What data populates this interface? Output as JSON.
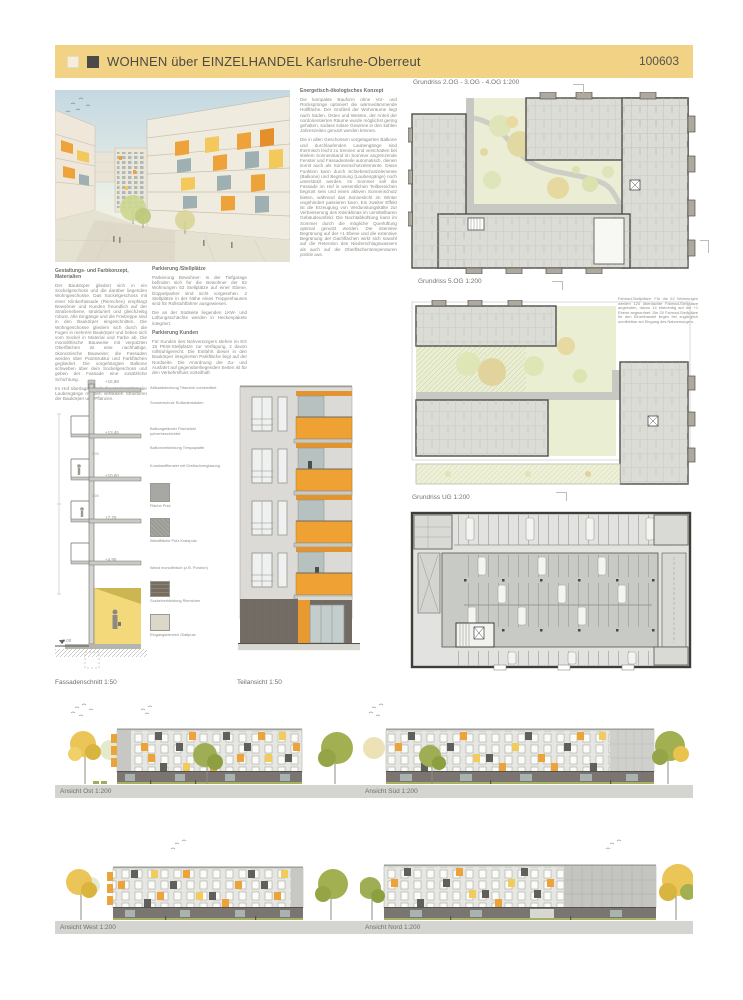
{
  "header": {
    "title": "WOHNEN über EINZELHANDEL Karlsruhe-Oberreut",
    "number": "100603"
  },
  "texts": {
    "materials": {
      "heading": "Gestaltungs- und Farbkonzept, Materialien",
      "body": "Der Baukörper gliedert sich in ein Sockelgeschoss und die darüber liegenden Wohngeschosse. Das Sockelgeschoss mit einer Klinkerfassade (Riemchen) empfängt Bewohner und Kunden freundlich auf der Straßenebene, strukturiert und gleichzeitig robust. Alle Eingänge und die Freitreppe sind in den Baukörper eingeschnitten. Die Wohngeschosse gliedern sich durch die Fugen in mehrere Baukörper und heben sich vom Sockel in Material und Farbe ab. Die monolithische Bauweise mit verputzten Oberflächen ist eine nachhaltige, ökonomische Bauweise; die Fassaden werden über Putzstruktur und Farbflächen gegliedert. Die vorgehängten Balkone schweben über dem Sockelgeschoss und geben der Fassade eine zusätzliche Schichtung.",
      "body2": "Im Hof überlagern sich die Horizontalen der Laubengänge mit den vertikalen Strukturen der Baukörper und Pflanzen."
    },
    "parking": {
      "heading": "Parkierung /Stellplätze",
      "body": "Parkierung Bewohner: In der Tiefgarage befinden sich für die Bewohner der 62 Wohnungen 62 Stellplätze auf einer Ebene. Doppelparker sind nicht vorgesehen. 2 Stellplätze in der Nähe eines Treppenhauses sind für Rollstuhlfahrer ausgewiesen.",
      "body2": "Die an der Südseite liegenden LKW- und Lüftungsschächte werden in Heckenpakete integriert.",
      "heading2": "Parkierung Kunden",
      "body3": "Für Kunden des Nahversorgers stehen im EG 18 PKW-Stellplätze zur Verfügung, 2 davon rollstuhlgerecht. Die Einfahrt dieser in den Baukörper integrierten Parkfläche liegt auf der Nordseite. Die Anordnung der Zu- und Ausfahrt auf gegenüberliegenden Seiten ist für den Verkehrsfluss vorteilhaft."
    },
    "energy": {
      "heading": "Energetisch-ökologisches Konzept",
      "body": "Die kompakte Bauform ohne Vor- und Rücksprünge optimiert die wärmedämmende Hüllfläche. Der Großteil der Wohnräume liegt nach Süden, Osten und Westen, der Anteil der nordorientierten Räume wurde möglichst gering gehalten, sodass solare Gewinne in den kühlen Jahreszeiten genutzt werden können.",
      "body2": "Die in allen Geschossen vorgelagerten Balkone und durchlaufenden Laubengänge sind thermisch leicht zu trennen und verschatten bei steilem Sonnenstand im Sommer angrenzende Fenster und Fassadenteile automatisch, dienen somit auch als Sonnenschutzelemente. Diese Funktion kann durch Schiebeschutzelemente (Balkone) und Begrünung (Laubengänge) noch unterstützt werden. Im Sommer soll die Fassade im Hof in wesentlichen Teilbereichen begrünt sein und einen aktiven Sonnenschutz bieten, während das Sonnenlicht im Winter ungehindert passieren kann. Ein zweiter Effekt ist die Erzeugung von Verdunstungskälte zur Verbesserung des Kleinklimas im unmittelbaren Gebäudeumfeld. Die Nachtabkühlung kann im Sommer durch die mögliche Querlüftung optimal genutzt werden. Die intensive Begrünung auf der +1 Ebene und die extensive Begrünung der Dachflächen wirkt sich sowohl auf die Retention des Niederschlagswassers als auch auf die Oberflächentemperaturen positiv aus."
    },
    "bike": {
      "body": "Fahrrad-Stellplätze: Für die 62 Wohnungen werden 124 überdachte Fahrrad-Stellplätze angeboten, davon 14 ebenerdig auf der +1 Ebene angeordnet. Die 20 Fahrrad-Stellplätze für den Einzelhandel liegen frei zugänglich unmittelbar am Eingang des Nahversorgers."
    }
  },
  "plans": {
    "plan1_label": "Grundriss 2.OG - 3.OG - 4.OG 1:200",
    "plan2_label": "Grundriss 5.OG 1:200",
    "plan3_label": "Grundriss UG 1:200"
  },
  "section": {
    "label": "Fassadenschnitt 1:50",
    "levels": [
      "+16,88",
      "+13,45",
      "+10,60",
      "+7,75",
      "+4,90",
      "±0,00"
    ],
    "storey": "3,00",
    "callouts": [
      "Attikaabdeckung Titanzink vorbewittert",
      "Sonnenschutz Rollladenkästen",
      "Balkongeländer Flachstahl pulverbeschichtet",
      "Balkonverkleidung Trespaplatte",
      "Kunststofffenster mit Dreifachverglasung",
      "Fläche Putz",
      "Wandfläche Putz Kratzputz",
      "Wand monolithisch (z.B. Poroton)",
      "Sockelverkleidung Riemchen",
      "Eingangsbereich Glattputz"
    ]
  },
  "partial": {
    "label": "Teilansicht 1:50"
  },
  "elevations": {
    "east": "Ansicht Ost 1:200",
    "south": "Ansicht Süd 1:200",
    "west": "Ansicht West 1:200",
    "north": "Ansicht Nord 1:200"
  },
  "colors": {
    "banner_yellow": "#f2d285",
    "accent_orange": "#ec9f33",
    "accent_yellow": "#f0c75a",
    "base_dark": "#776f6a",
    "courtyard_green": "#ebeed5",
    "tree_yellow": "#eac24e",
    "tree_olive": "#a3b052"
  }
}
